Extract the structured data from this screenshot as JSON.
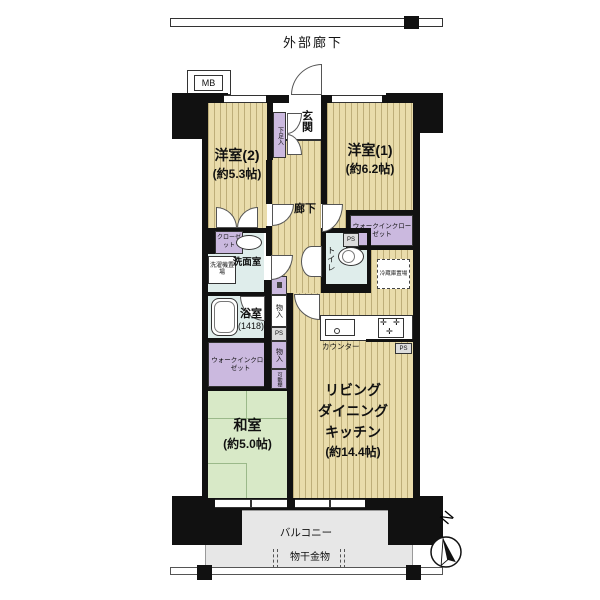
{
  "plan": {
    "outer_corridor": "外部廊下",
    "mb": "MB",
    "genkan": "玄関",
    "getabako": "下足入",
    "hallway": "廊下",
    "room2": {
      "name": "洋室(2)",
      "size": "(約5.3帖)"
    },
    "room1": {
      "name": "洋室(1)",
      "size": "(約6.2帖)"
    },
    "wic": "ウォークインクローゼット",
    "toilet": "トイレ",
    "refrigerator": "冷蔵庫置場",
    "closet": "クローゼット",
    "washroom": "洗面室",
    "laundry": "洗濯機置場",
    "bath": {
      "name": "浴室",
      "size": "(1418)"
    },
    "storage": "物入",
    "ps": "PS",
    "shelf": "可動棚",
    "washitsu": {
      "name": "和室",
      "size": "(約5.0帖)"
    },
    "ldk": {
      "line1": "リビング",
      "line2": "ダイニング",
      "line3": "キッチン",
      "size": "(約14.4帖)"
    },
    "counter": "カウンター",
    "balcony": "バルコニー",
    "drying": "物干金物",
    "north": "N"
  },
  "icons": {
    "burner": "✛"
  },
  "colors": {
    "wall": "#111111",
    "wood_floor": "#e9dcab",
    "tatami": "#d8e9c7",
    "wet_area": "#dfedeb",
    "closet": "#cbb9df",
    "balcony": "#e7e7e7"
  }
}
